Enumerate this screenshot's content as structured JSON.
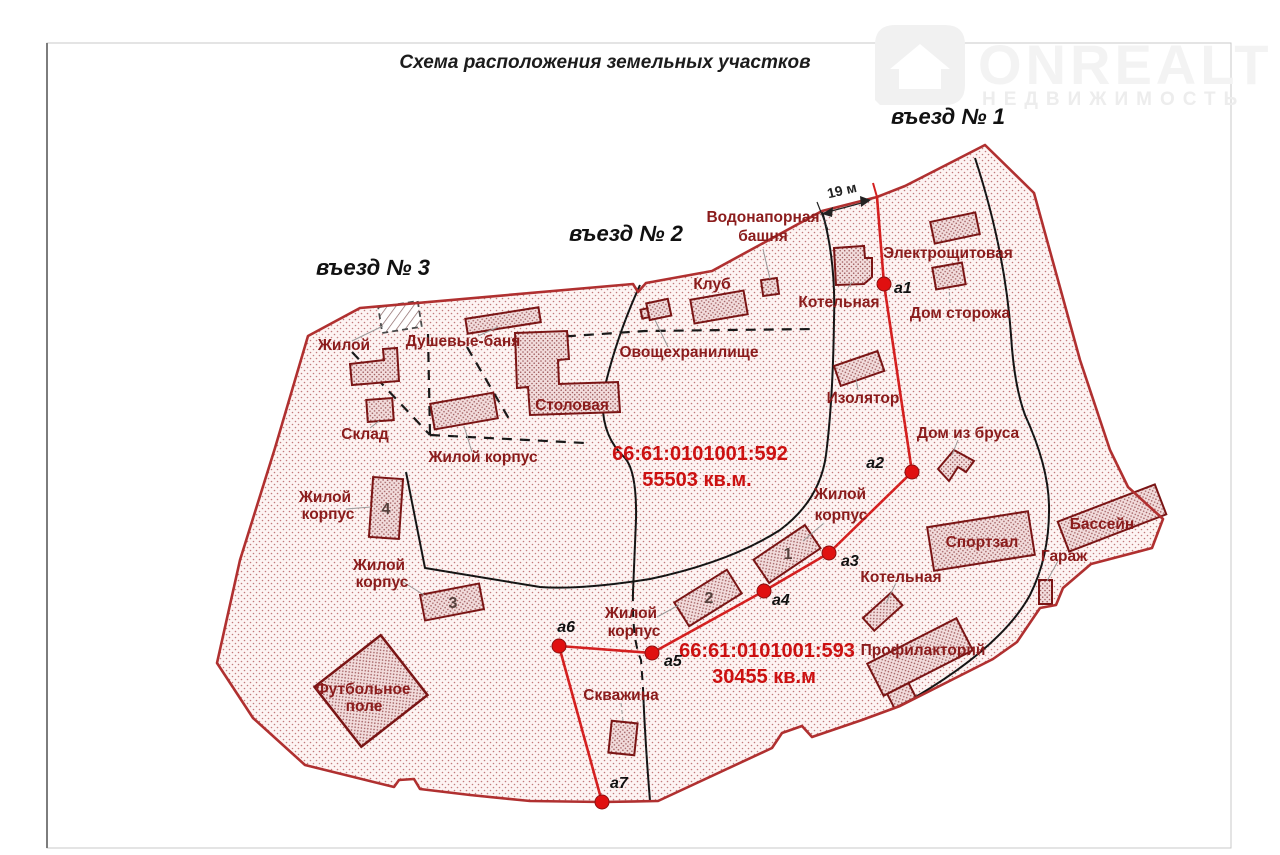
{
  "title": "Схема расположения земельных участков",
  "logo": {
    "brand": "ONREALT",
    "tagline": "НЕДВИЖИМОСТЬ"
  },
  "entrances": {
    "e1": "въезд № 1",
    "e2": "въезд № 2",
    "e3": "въезд № 3"
  },
  "dimension_label": "19 м",
  "parcels": {
    "p592": {
      "cadastral": "66:61:0101001:592",
      "area": "55503 кв.м."
    },
    "p593": {
      "cadastral": "66:61:0101001:593",
      "area": "30455 кв.м"
    }
  },
  "points": {
    "a1": "а1",
    "a2": "а2",
    "a3": "а3",
    "a4": "а4",
    "a5": "а5",
    "a6": "а6",
    "a7": "а7"
  },
  "labels": {
    "vodonapornaya_1": "Водонапорная",
    "vodonapornaya_2": "башня",
    "klub": "Клуб",
    "kotelnaya_top": "Котельная",
    "elektroshchitovaya": "Электрощитовая",
    "dom_storozha": "Дом сторожа",
    "zhiloy": "Жилой",
    "dushevye_banya": "Душевые-баня",
    "ovoshchekhranilishche": "Овощехранилище",
    "sklad": "Склад",
    "stolovaya": "Столовая",
    "zhiloy_korpus": "Жилой корпус",
    "zh": "Жилой",
    "k": "корпус",
    "izolyator": "Изолятор",
    "dom_iz_brusa": "Дом из бруса",
    "futbolnoe": "Футбольное",
    "pole": "поле",
    "skvazhina": "Скважина",
    "sportzal": "Спортзал",
    "bassein": "Бассейн",
    "garazh": "Гараж",
    "kotelnaya_bottom": "Котельная",
    "profilaktoriy": "Профилакторий"
  },
  "building_numbers": {
    "b1": "1",
    "b2": "2",
    "b3": "3",
    "b4": "4"
  },
  "colors": {
    "boundary": "#b03030",
    "divider": "#d42020",
    "point_dot": "#e01010",
    "building_outline": "#7a1515",
    "building_label": "#8b1c1c",
    "cadastral_text": "#cc1111",
    "land_dot": "#c27a7c"
  }
}
